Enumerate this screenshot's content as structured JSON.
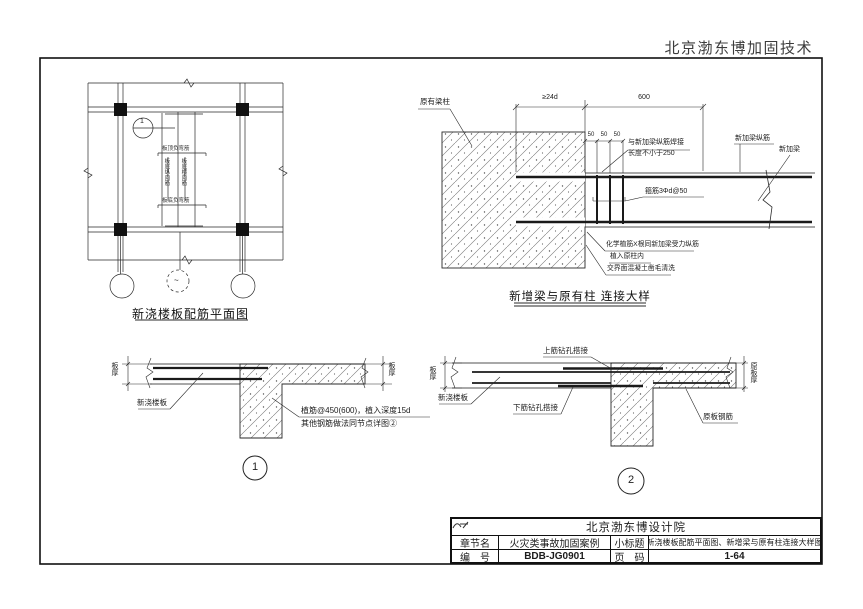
{
  "header": {
    "company": "北京渤东博加固技术"
  },
  "plan": {
    "title": "新浇楼板配筋平面图",
    "callout_number": "1",
    "axis_bubble_mark": "~",
    "top_rebar_label": "板顶负弯筋",
    "left_rebar_label": "板底纵向筋",
    "right_rebar_label": "板底横向筋",
    "bottom_rebar_label": "板底负弯筋"
  },
  "beam_detail": {
    "title": "新增梁与原有柱 连接大样",
    "existing_column": "原有梁柱",
    "dim_anchorage": "≥24d",
    "dim_beam": "600",
    "dim_s1": "50",
    "dim_s2": "50",
    "dim_s3": "50",
    "weld_note_1": "与新加梁纵筋焊接",
    "weld_note_2": "长度不小于250",
    "new_beam_bars": "新加梁纵筋",
    "new_beam": "新加梁",
    "stirrup_note": "箍筋3Φd@50",
    "plant_note_1": "化学植筋X根同新加梁受力纵筋",
    "plant_note_2": "植入原柱内",
    "plant_note_3": "交界面混凝土凿毛清洗"
  },
  "detail_1": {
    "number": "1",
    "dim_left": "板厚",
    "dim_right": "板厚",
    "new_slab": "新浇楼板",
    "note_1": "植筋@450(600)，植入深度15d",
    "note_2": "其他钢筋做法同节点详图②"
  },
  "detail_2": {
    "number": "2",
    "dim_left": "板厚",
    "dim_right": "原板厚",
    "new_slab": "新浇楼板",
    "top_lap": "上筋钻孔搭接",
    "bottom_lap": "下筋钻孔搭接",
    "existing_bars": "原板钢筋"
  },
  "title_block": {
    "institute": "北京渤东博设计院",
    "row1_label1": "章节名",
    "row1_value1": "火灾类事故加固案例",
    "row1_label2": "小标题",
    "row1_value2": "新浇楼板配筋平面图、新增梁与原有柱连接大样图",
    "row2_label1": "编　号",
    "row2_value1": "BDB-JG0901",
    "row2_label2": "页　码",
    "row2_value2": "1-64"
  }
}
